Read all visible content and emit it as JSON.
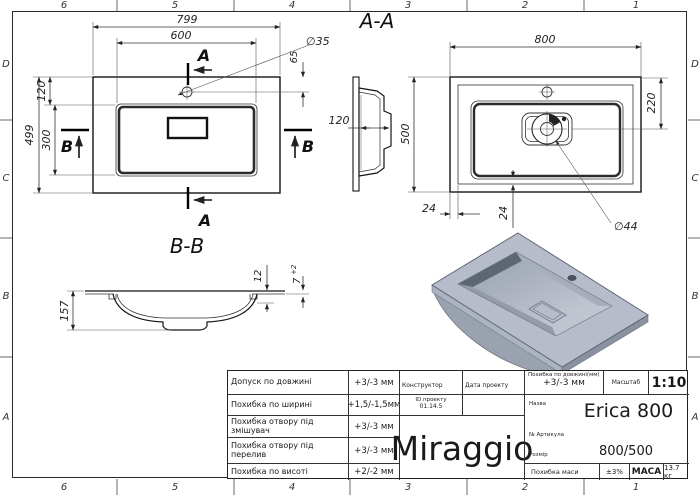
{
  "frame": {
    "top_zones": [
      "6",
      "5",
      "4",
      "3",
      "2",
      "1"
    ],
    "bottom_zones": [
      "6",
      "5",
      "4",
      "3",
      "2",
      "1"
    ],
    "left_zones": [
      "D",
      "C",
      "B",
      "A"
    ],
    "right_zones": [
      "D",
      "C",
      "B",
      "A"
    ]
  },
  "plan": {
    "dim_799": "799",
    "dim_600": "600",
    "dim_499": "499",
    "dim_120": "120",
    "dim_300": "300",
    "dim_65": "65",
    "hole_dia": "∅35",
    "section_a_top": "A",
    "section_a_bottom": "A",
    "section_b_left": "B",
    "section_b_right": "B"
  },
  "aa": {
    "title": "A-A",
    "dim_800": "800",
    "dim_500": "500",
    "dim_220": "220",
    "dim_24_left": "24",
    "dim_24_bottom": "24",
    "dim_120": "120",
    "drain_dia": "∅44"
  },
  "bb": {
    "title": "B-B",
    "dim_157": "157",
    "dim_12": "12",
    "dim_7": "7",
    "dim_7_tol": "+2"
  },
  "tb": {
    "rows": [
      {
        "label": "Допуск по довжині",
        "value": "+3/-3 мм"
      },
      {
        "label": "Похибка по ширині",
        "value": "+1,5/-1,5мм"
      },
      {
        "label": "Похибка отвору під змішувач",
        "value": "+3/-3 мм"
      },
      {
        "label": "Похибка отвору під перелив",
        "value": "+3/-3 мм"
      },
      {
        "label": "Похибка по висоті",
        "value": "+2/-2 мм"
      }
    ],
    "constructor_label": "Конструктор",
    "date_label": "Дата проекту",
    "project_id_label": "ID проекту",
    "project_id": "01.14.5",
    "logo": "Miraggio",
    "length_tol_label": "Похибка по довжині(мм)",
    "length_tol": "+3/-3 мм",
    "scale_label": "Масштаб",
    "scale": "1:10",
    "name_label": "Назва",
    "name": "Erica 800",
    "article_label": "№ Артикула",
    "size_label": "Розмір",
    "size": "800/500",
    "mass_tol_label": "Похибка маси",
    "mass_tol": "±3%",
    "mass_label": "МАСА",
    "mass": "13.7 кг"
  }
}
